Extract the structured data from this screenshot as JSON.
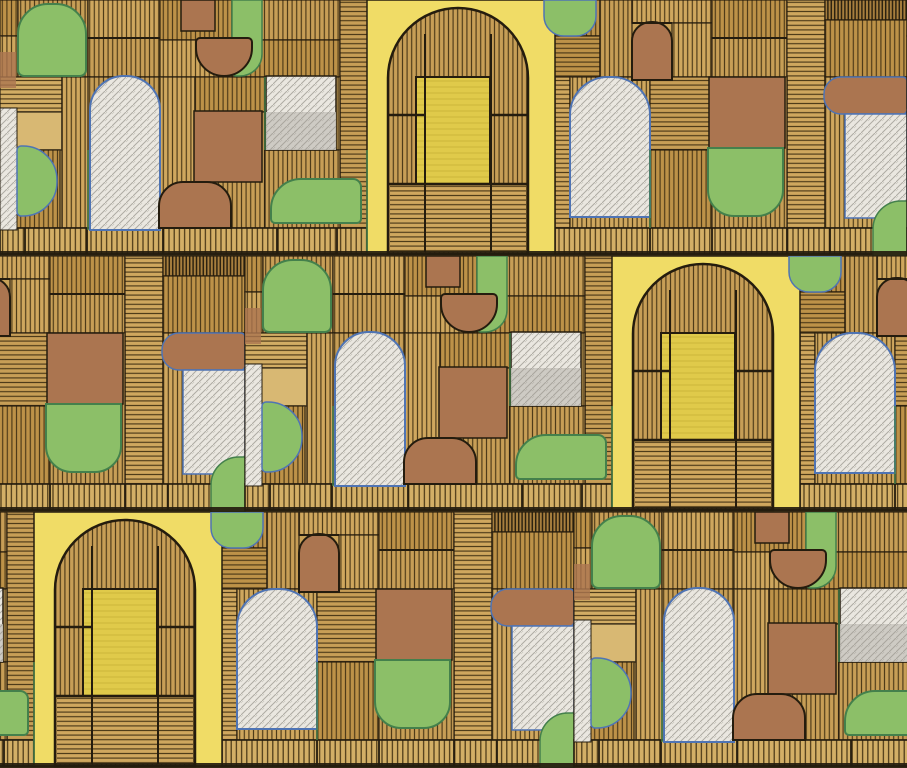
{
  "meta": {
    "kind": "scanned hand-drawn marker and ink geometric pattern",
    "width_px": 907,
    "height_px": 768
  },
  "palette": {
    "paper": "#c9a258",
    "tan_shades": [
      "#c79e56",
      "#bd9248",
      "#cfa75e",
      "#d2ad64"
    ],
    "tan_wash": "#d8b873",
    "tan_dark": "#a87f3e",
    "hatch_line": "#4a3817",
    "hatch_line_dark": "#2c2210",
    "band_base": "#d3af66",
    "ink": "#241c0e",
    "yellow_panel": "#f0dc66",
    "yellow_deep": "#e0ca4a",
    "yellow_streak": "#cdb53a",
    "green": "#8cbf68",
    "green_edge": "#44804c",
    "blue_edge": "#4f74b4",
    "brown": "#ab7550",
    "brown_edge": "#352a18",
    "white": "#eae7e0",
    "gray": "#cbc8c1",
    "pencil": "#a3a098"
  },
  "pattern": {
    "strip_width": 907,
    "row_height": 256,
    "rows_y": [
      0,
      256,
      512
    ],
    "row_offsets": [
      0,
      245,
      574
    ],
    "bg_patches": [
      [
        0,
        0,
        18,
        36,
        "v",
        1
      ],
      [
        0,
        36,
        18,
        72,
        "v",
        2
      ],
      [
        18,
        0,
        70,
        77,
        "v",
        0
      ],
      [
        88,
        0,
        72,
        38,
        "v",
        2
      ],
      [
        88,
        38,
        72,
        39,
        "v",
        0
      ],
      [
        160,
        0,
        72,
        40,
        "v",
        1
      ],
      [
        160,
        40,
        105,
        37,
        "v",
        2
      ],
      [
        232,
        0,
        108,
        40,
        "v",
        0
      ],
      [
        232,
        40,
        108,
        37,
        "v",
        1
      ],
      [
        340,
        0,
        28,
        228,
        "h",
        0
      ],
      [
        0,
        77,
        62,
        35,
        "h",
        3
      ],
      [
        0,
        112,
        62,
        38,
        "w",
        3
      ],
      [
        62,
        77,
        28,
        151,
        "v",
        2
      ],
      [
        0,
        150,
        60,
        78,
        "v",
        1
      ],
      [
        88,
        77,
        72,
        151,
        "v",
        0
      ],
      [
        160,
        77,
        35,
        151,
        "v",
        2
      ],
      [
        195,
        77,
        70,
        35,
        "v",
        1
      ],
      [
        195,
        112,
        70,
        116,
        "v",
        0
      ],
      [
        265,
        77,
        75,
        73,
        "v",
        2
      ],
      [
        265,
        150,
        75,
        78,
        "v",
        0
      ],
      [
        555,
        0,
        45,
        36,
        "v",
        1
      ],
      [
        540,
        36,
        60,
        41,
        "h",
        1
      ],
      [
        555,
        77,
        15,
        151,
        "h",
        2
      ],
      [
        600,
        0,
        32,
        77,
        "v",
        0
      ],
      [
        632,
        0,
        80,
        23,
        "v",
        2
      ],
      [
        672,
        23,
        40,
        54,
        "v",
        2
      ],
      [
        712,
        0,
        75,
        38,
        "v",
        1
      ],
      [
        712,
        38,
        75,
        40,
        "v",
        0
      ],
      [
        787,
        0,
        38,
        228,
        "h",
        2
      ],
      [
        825,
        0,
        82,
        20,
        "vd",
        0
      ],
      [
        825,
        20,
        82,
        57,
        "v",
        1
      ],
      [
        570,
        77,
        80,
        151,
        "v",
        2
      ],
      [
        650,
        77,
        62,
        73,
        "h",
        0
      ],
      [
        650,
        150,
        62,
        78,
        "v",
        1
      ],
      [
        712,
        77,
        75,
        151,
        "v",
        0
      ],
      [
        825,
        77,
        82,
        151,
        "v",
        2
      ]
    ],
    "band": {
      "y": 228,
      "h": 26,
      "segments": [
        [
          0,
          368
        ],
        [
          555,
          352
        ]
      ],
      "dividers": [
        25,
        87,
        163,
        277,
        337,
        650,
        712,
        787,
        830
      ],
      "bottom_line_y": 251,
      "bottom_line_h": 5
    },
    "shapes": [
      {
        "n": "green-arch-top-left",
        "x": 18,
        "y": 4,
        "w": 68,
        "h": 72,
        "r": [
          30,
          30,
          6,
          6
        ],
        "f": "g",
        "s": "gb",
        "sw": 2
      },
      {
        "n": "brown-wash-left-edge",
        "x": 0,
        "y": 52,
        "w": 16,
        "h": 36,
        "r": [
          0,
          0,
          0,
          0
        ],
        "f": "b",
        "s": "n",
        "sw": 0,
        "o": 0.8
      },
      {
        "n": "white-sliver-left-edge",
        "x": 0,
        "y": 108,
        "w": 17,
        "h": 122,
        "r": [
          0,
          0,
          0,
          0
        ],
        "f": "w",
        "s": "i",
        "sw": 1,
        "p": 1
      },
      {
        "n": "green-half-disc-left",
        "x": 17,
        "y": 146,
        "w": 40,
        "h": 70,
        "r": [
          4,
          34,
          34,
          4
        ],
        "f": "g",
        "s": "bl",
        "sw": 1.5
      },
      {
        "n": "white-arch-1",
        "x": 90,
        "y": 76,
        "w": 70,
        "h": 154,
        "r": [
          34,
          34,
          0,
          0
        ],
        "f": "w",
        "s": "bl",
        "sw": 2,
        "p": 1
      },
      {
        "n": "brown-rect-top",
        "x": 181,
        "y": 0,
        "w": 34,
        "h": 31,
        "r": [
          0,
          0,
          0,
          0
        ],
        "f": "b",
        "s": "i",
        "sw": 1.5
      },
      {
        "n": "green-hanging-slab",
        "x": 232,
        "y": 0,
        "w": 30,
        "h": 76,
        "r": [
          0,
          0,
          22,
          4
        ],
        "f": "g",
        "s": "gb",
        "sw": 1.5
      },
      {
        "n": "brown-hanging-disc",
        "x": 196,
        "y": 38,
        "w": 56,
        "h": 38,
        "r": [
          4,
          4,
          28,
          28
        ],
        "f": "b",
        "s": "i",
        "sw": 2
      },
      {
        "n": "white-rect-mid",
        "x": 266,
        "y": 76,
        "w": 70,
        "h": 74,
        "r": [
          0,
          0,
          0,
          0
        ],
        "f": "w",
        "s": "i",
        "sw": 1.5,
        "p": 1
      },
      {
        "n": "gray-rect-mid-lower",
        "x": 266,
        "y": 112,
        "w": 70,
        "h": 38,
        "r": [
          0,
          0,
          0,
          0
        ],
        "f": "gr",
        "s": "n",
        "sw": 0,
        "p": 1,
        "o": 0.9
      },
      {
        "n": "brown-square-1",
        "x": 194,
        "y": 111,
        "w": 68,
        "h": 71,
        "r": [
          0,
          0,
          0,
          0
        ],
        "f": "b",
        "s": "i",
        "sw": 1.5
      },
      {
        "n": "brown-blob-bottom",
        "x": 159,
        "y": 182,
        "w": 72,
        "h": 46,
        "r": [
          24,
          24,
          0,
          0
        ],
        "f": "b",
        "s": "i",
        "sw": 2
      },
      {
        "n": "green-bar-1",
        "x": 271,
        "y": 179,
        "w": 90,
        "h": 44,
        "r": [
          30,
          8,
          4,
          4
        ],
        "f": "g",
        "s": "gb",
        "sw": 2
      },
      {
        "n": "yellow-door-panel",
        "x": 367,
        "y": 0,
        "w": 188,
        "h": 254,
        "r": [
          0,
          0,
          0,
          0
        ],
        "f": "yp",
        "s": "i",
        "sw": 1.5
      },
      {
        "n": "hatched-arch-ring",
        "x": 388,
        "y": 8,
        "w": 140,
        "h": 246,
        "r": [
          70,
          70,
          0,
          0
        ],
        "f": "hv0",
        "s": "i",
        "sw": 2.5
      },
      {
        "n": "hatched-arch-floor",
        "x": 390,
        "y": 184,
        "w": 136,
        "h": 68,
        "r": [
          0,
          0,
          0,
          0
        ],
        "f": "hh2",
        "s": "n",
        "sw": 0
      },
      {
        "n": "yellow-inner-door",
        "x": 416,
        "y": 77,
        "w": 74,
        "h": 107,
        "r": [
          0,
          0,
          0,
          0
        ],
        "f": "yd",
        "s": "i",
        "sw": 2,
        "ys": 1
      },
      {
        "n": "green-half-disc-top-2",
        "x": 544,
        "y": 0,
        "w": 52,
        "h": 36,
        "r": [
          0,
          0,
          20,
          20
        ],
        "f": "g",
        "s": "bl",
        "sw": 1.5
      },
      {
        "n": "white-arch-2",
        "x": 570,
        "y": 77,
        "w": 80,
        "h": 140,
        "r": [
          38,
          38,
          0,
          0
        ],
        "f": "w",
        "s": "bl",
        "sw": 2,
        "p": 1
      },
      {
        "n": "small-brown-arch",
        "x": 632,
        "y": 22,
        "w": 40,
        "h": 58,
        "r": [
          19,
          19,
          0,
          0
        ],
        "f": "b",
        "s": "i",
        "sw": 2
      },
      {
        "n": "brown-square-2",
        "x": 709,
        "y": 77,
        "w": 76,
        "h": 71,
        "r": [
          0,
          0,
          0,
          0
        ],
        "f": "b",
        "s": "i",
        "sw": 1.5
      },
      {
        "n": "green-under-square-2",
        "x": 708,
        "y": 148,
        "w": 75,
        "h": 68,
        "r": [
          0,
          0,
          26,
          26
        ],
        "f": "g",
        "s": "gb",
        "sw": 2
      },
      {
        "n": "brown-rounded-bar-right",
        "x": 824,
        "y": 77,
        "w": 83,
        "h": 37,
        "r": [
          17,
          4,
          4,
          17
        ],
        "f": "b",
        "s": "bl",
        "sw": 1.5
      },
      {
        "n": "white-rect-right",
        "x": 845,
        "y": 114,
        "w": 62,
        "h": 104,
        "r": [
          0,
          0,
          0,
          0
        ],
        "f": "w",
        "s": "bl",
        "sw": 1.5,
        "p": 1
      },
      {
        "n": "green-disc-bottom-right",
        "x": 873,
        "y": 201,
        "w": 34,
        "h": 55,
        "r": [
          28,
          0,
          0,
          0
        ],
        "f": "g",
        "s": "gb",
        "sw": 1.5
      }
    ],
    "ink_lines": [
      [
        425,
        34,
        425,
        252,
        2
      ],
      [
        491,
        34,
        491,
        252,
        2
      ],
      [
        388,
        115,
        425,
        115,
        2.5
      ],
      [
        491,
        115,
        528,
        115,
        2.5
      ],
      [
        389,
        184,
        527,
        184,
        2.5
      ],
      [
        88,
        38,
        160,
        38,
        2
      ],
      [
        712,
        38,
        787,
        38,
        2
      ],
      [
        632,
        23,
        672,
        23,
        2
      ]
    ],
    "green_lines": [
      [
        367,
        150,
        367,
        254
      ],
      [
        265,
        77,
        265,
        150
      ],
      [
        650,
        150,
        650,
        228
      ],
      [
        88,
        150,
        88,
        230
      ]
    ]
  }
}
